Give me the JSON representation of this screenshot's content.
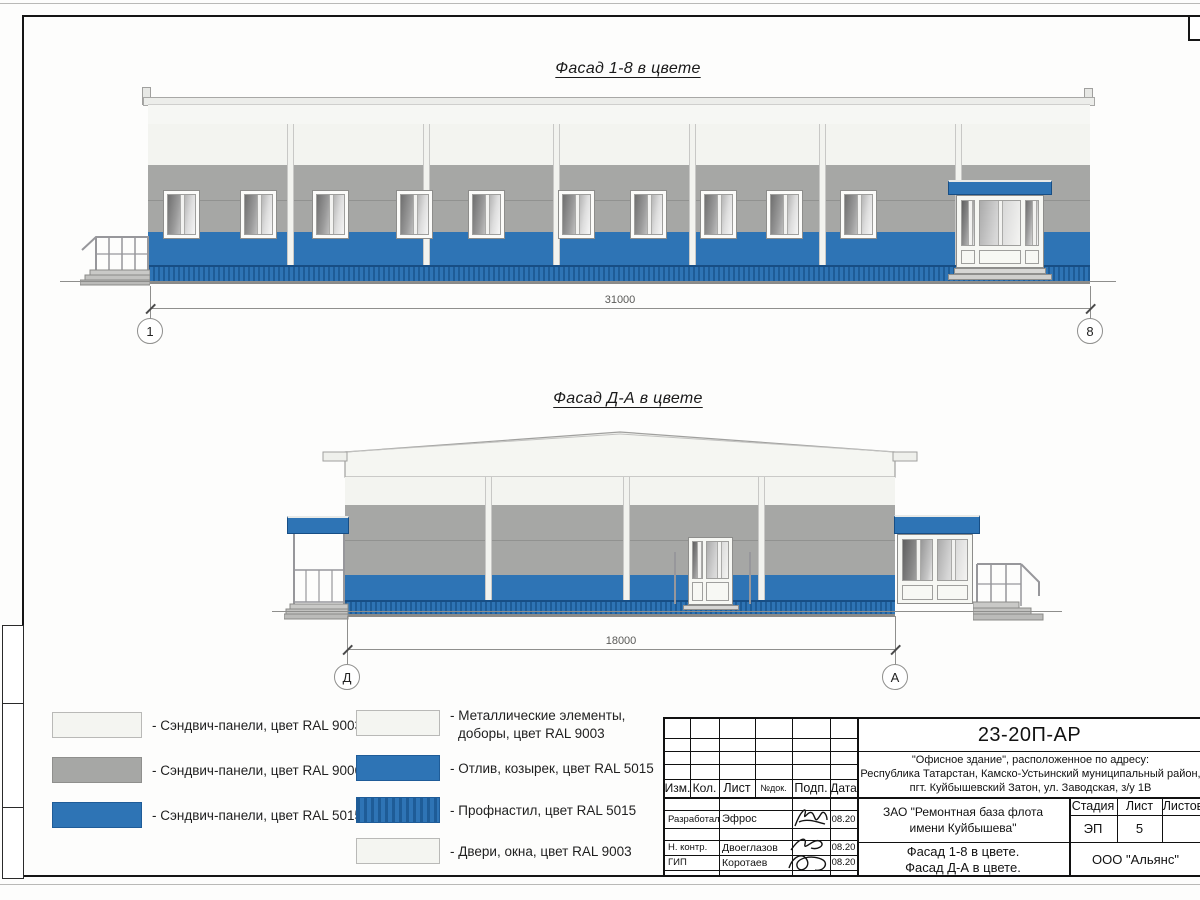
{
  "drawing": {
    "facade_top": {
      "title": "Фасад 1-8 в цвете",
      "dimension": "31000",
      "axis_left": "1",
      "axis_right": "8"
    },
    "facade_bottom": {
      "title": "Фасад Д-А в цвете",
      "dimension": "18000",
      "axis_left": "Д",
      "axis_right": "А"
    }
  },
  "legend": {
    "left_column": [
      {
        "swatch": "ral9003-white",
        "label": "- Сэндвич-панели, цвет RAL 9003"
      },
      {
        "swatch": "ral9006-gray",
        "label": "- Сэндвич-панели, цвет RAL 9006"
      },
      {
        "swatch": "ral5015-blue",
        "label": "- Сэндвич-панели, цвет RAL 5015"
      }
    ],
    "right_column": [
      {
        "swatch": "ral9003-white",
        "lines": [
          "- Металлические элементы,",
          "доборы, цвет RAL 9003"
        ]
      },
      {
        "swatch": "ral5015-blue",
        "lines": [
          "- Отлив, козырек, цвет RAL 5015"
        ]
      },
      {
        "swatch": "ral5015-profiled",
        "lines": [
          "- Профнастил, цвет RAL 5015"
        ]
      },
      {
        "swatch": "ral9003-white",
        "lines": [
          "- Двери, окна, цвет RAL 9003"
        ]
      }
    ]
  },
  "title_block": {
    "doc_number": "23-20П-АР",
    "object_lines": [
      "\"Офисное здание\", расположенное по адресу:",
      "Республика Татарстан, Камско-Устьинский муниципальный район,",
      "пгт. Куйбышевский Затон, ул. Заводская, з/у 1В"
    ],
    "columns": [
      "Изм.",
      "Кол.",
      "Лист",
      "№док.",
      "Подп.",
      "Дата"
    ],
    "signature_rows": [
      {
        "role": "Разработал",
        "name": "Эфрос",
        "date": "08.20"
      },
      {
        "role": "Н. контр.",
        "name": "Двоеглазов",
        "date": "08.20"
      },
      {
        "role": "ГИП",
        "name": "Коротаев",
        "date": "08.20"
      }
    ],
    "client_lines": [
      "ЗАО \"Ремонтная база флота",
      "имени Куйбышева\""
    ],
    "stage": {
      "label": "Стадия",
      "value": "ЭП"
    },
    "sheet": {
      "label": "Лист",
      "value": "5"
    },
    "sheets": {
      "label": "Листов",
      "value": ""
    },
    "sheet_title_lines": [
      "Фасад 1-8 в цвете.",
      "Фасад Д-А в цвете."
    ],
    "company": "ООО \"Альянс\""
  },
  "colors": {
    "panel_white": "#F3F4F0",
    "panel_gray": "#A6A7A5",
    "panel_blue": "#2E74B5",
    "profiled_dark": "#1E5C97"
  }
}
